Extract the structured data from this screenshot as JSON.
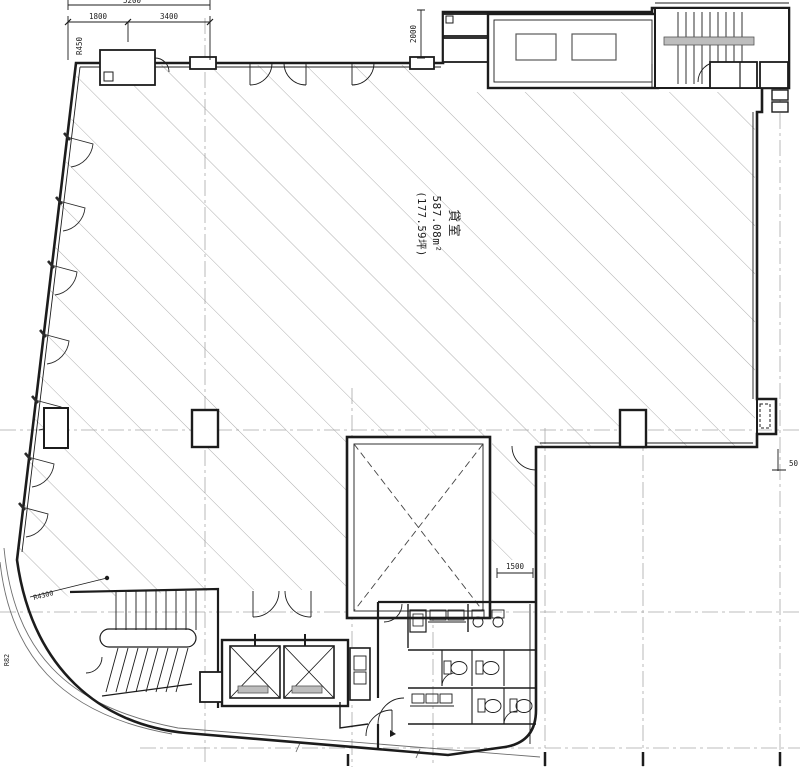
{
  "drawing": {
    "room_label": {
      "name": "貸室",
      "area_sqm": "587.08m²",
      "area_tsubo": "(177.59坪)"
    },
    "dimensions": {
      "total_top": "5200",
      "seg_1800": "1800",
      "seg_3400": "3400",
      "vert_2000": "2000",
      "passage_1500": "1500",
      "edge_50": "50"
    },
    "radii": {
      "top_left": "R450",
      "stair_curve": "R4300",
      "bottom_left": "R82"
    },
    "colors": {
      "wall": "#1c1c1c",
      "hatch": "#9a9a9a",
      "centerline": "#a8a8a8",
      "equipment_fill": "#bdbdbd",
      "background": "#ffffff"
    }
  }
}
